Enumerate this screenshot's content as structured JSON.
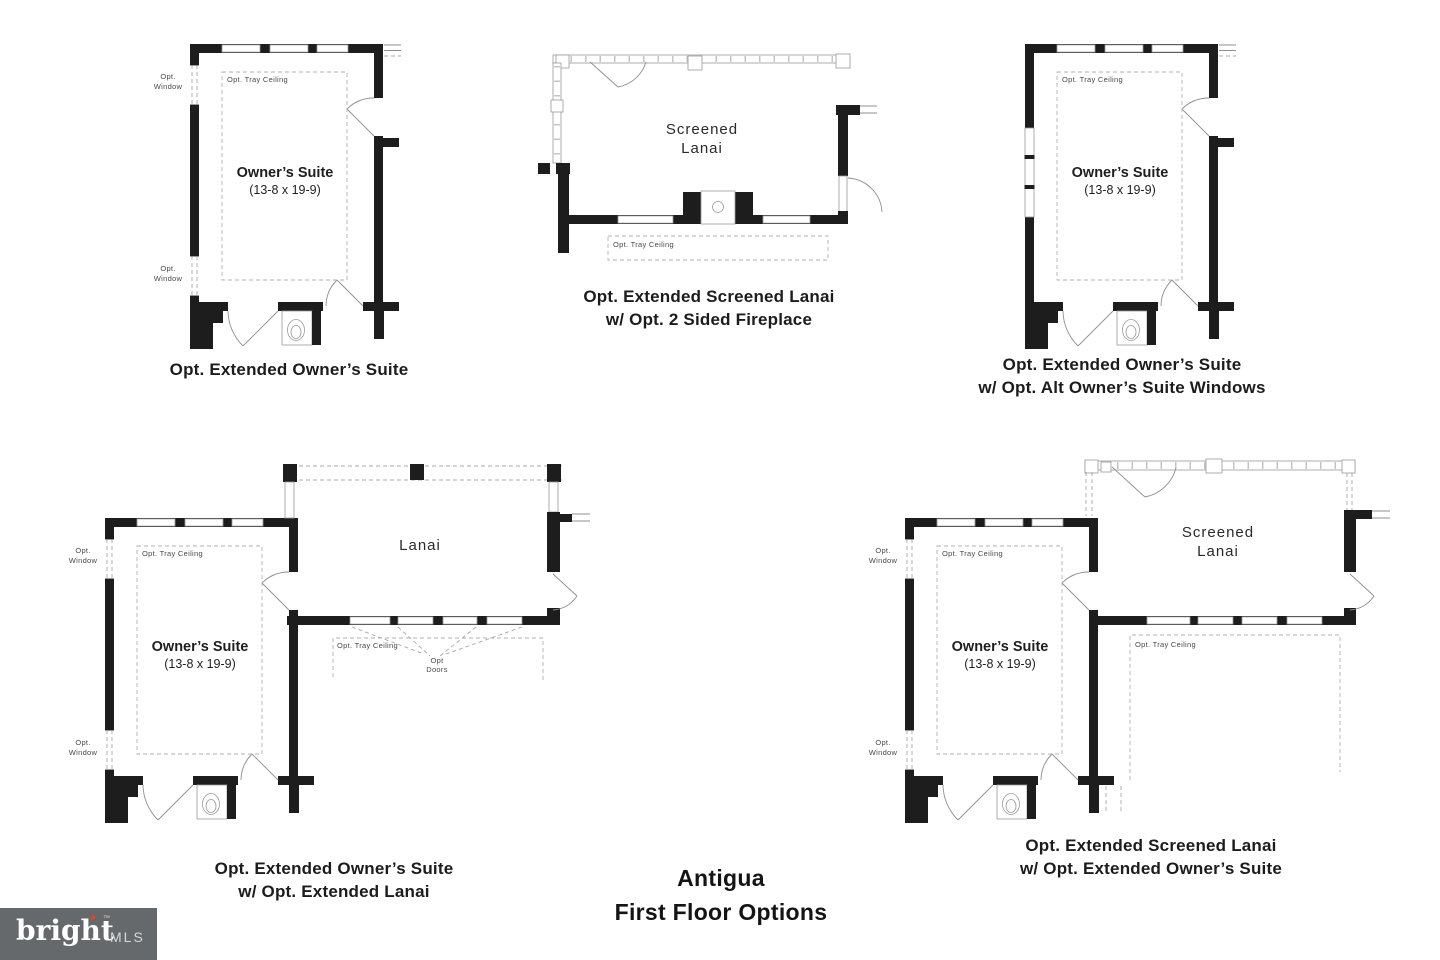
{
  "title": {
    "line1": "Antigua",
    "line2": "First Floor Options"
  },
  "logo": {
    "brand": "bright",
    "star_glyph": "✦",
    "tm": "™",
    "suffix": "MLS"
  },
  "shared": {
    "owners_suite": "Owner’s Suite",
    "owners_suite_dim": "(13-8 x 19-9)",
    "opt_tray_ceiling": "Opt. Tray Ceiling",
    "opt_window_line1": "Opt.",
    "opt_window_line2": "Window",
    "lanai": "Lanai",
    "screened_line1": "Screened",
    "screened_line2": "Lanai",
    "opt_doors_line1": "Opt",
    "opt_doors_line2": "Doors"
  },
  "plans": {
    "p1": {
      "caption_line1": "Opt. Extended Owner’s Suite",
      "caption_line2": ""
    },
    "p2": {
      "caption_line1": "Opt. Extended Screened Lanai",
      "caption_line2": "w/ Opt. 2 Sided Fireplace"
    },
    "p3": {
      "caption_line1": "Opt. Extended Owner’s Suite",
      "caption_line2": "w/ Opt. Alt Owner’s Suite Windows"
    },
    "p4": {
      "caption_line1": "Opt. Extended Owner’s Suite",
      "caption_line2": "w/ Opt. Extended Lanai"
    },
    "p5": {
      "caption_line1": "Opt. Extended Screened Lanai",
      "caption_line2": "w/ Opt. Extended Owner’s Suite"
    }
  },
  "colors": {
    "wall": "#1d1d1d",
    "thin_line": "#8f8f8f",
    "dash_line": "#a8a8a8",
    "text": "#1c1c1c",
    "logo_bg": "#66696c",
    "logo_star": "#d14a31",
    "logo_mls": "#d5d6d7"
  }
}
